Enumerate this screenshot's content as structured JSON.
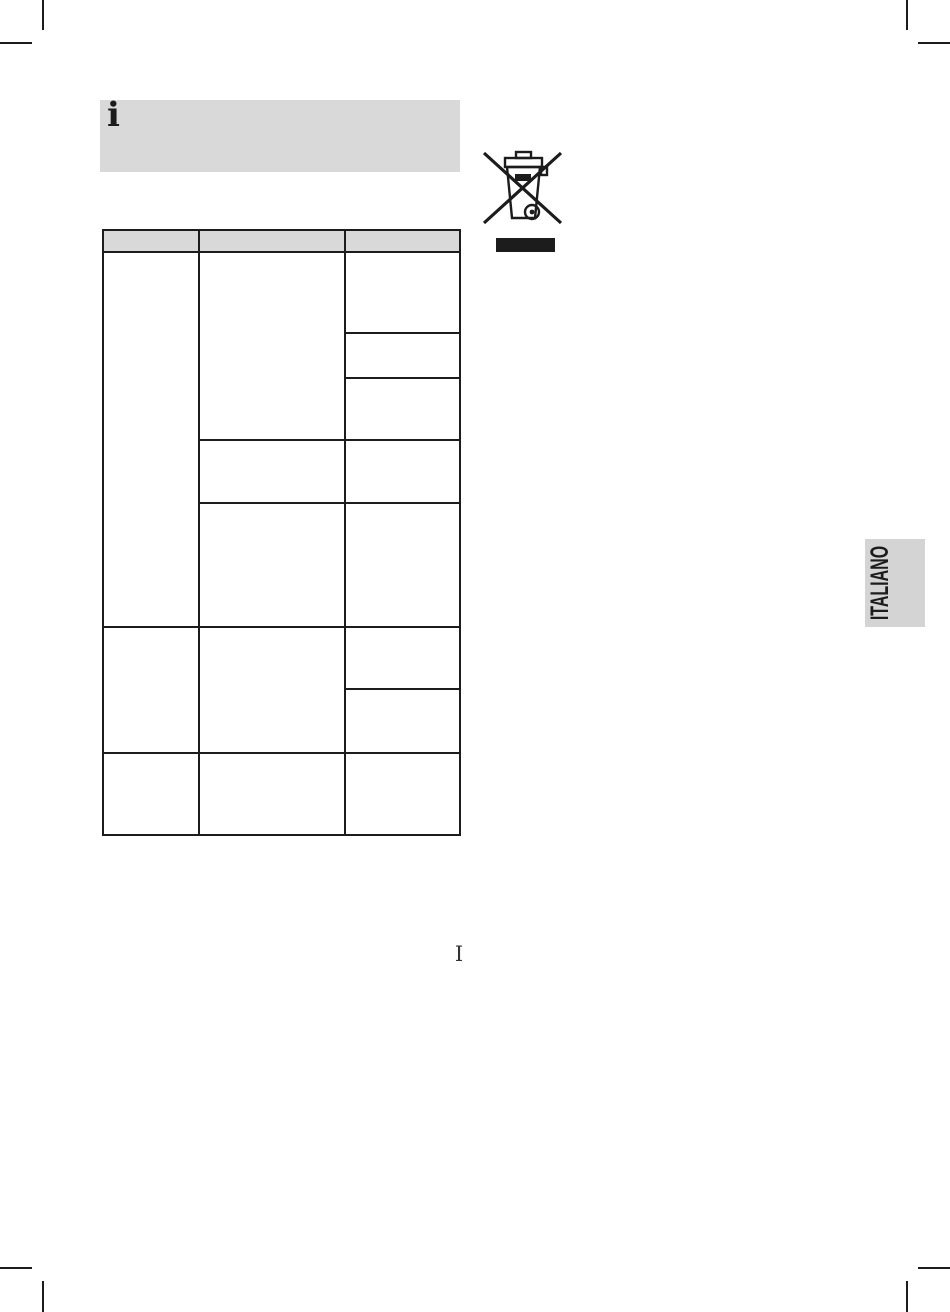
{
  "document": {
    "language_tab": "ITALIANO",
    "page_marker": "I"
  },
  "info_banner": {
    "icon_glyph": "i"
  },
  "icons": {
    "weee": "weee-crossed-out-wheelie-bin-icon"
  },
  "table": {
    "header": [
      "",
      "",
      ""
    ],
    "body_cells_empty": true,
    "column_count": 3
  },
  "colors": {
    "paper": "#ffffff",
    "ink": "#1c1c1c",
    "panel_gray": "#d9d9d9",
    "tab_gray": "#d4d4d4"
  }
}
